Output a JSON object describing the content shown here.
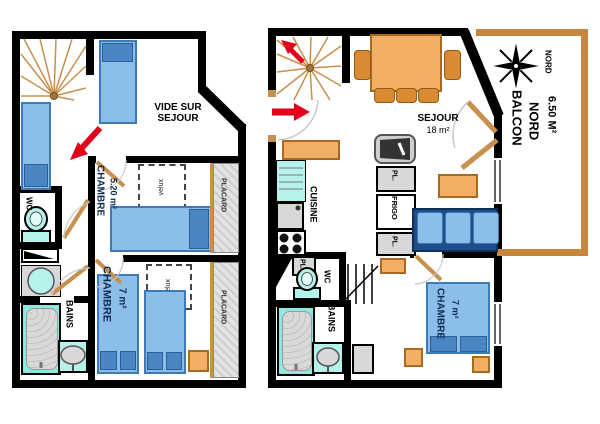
{
  "title": "Apartment floor plan - two levels",
  "left_plan": {
    "vide_sur_sejour": "VIDE SUR SEJOUR",
    "chambre1_name": "CHAMBRE",
    "chambre1_area": "5.20 m²",
    "velux1": "velux",
    "placard_top": "PLACARD",
    "chambre2_name": "CHAMBRE",
    "chambre2_area": "7 m²",
    "velux2": "velux",
    "placard_bottom": "PLACARD",
    "bains": "BAINS",
    "wc": "WC"
  },
  "right_plan": {
    "sejour_name": "SEJOUR",
    "sejour_area": "18 m²",
    "cuisine": "CUISINE",
    "pl_1": "PL.",
    "frigo": "FRIGO",
    "pl_2": "PL.",
    "pl_3": "PL.",
    "wc": "WC",
    "bains": "BAINS",
    "chambre_name": "CHAMBRE",
    "chambre_area": "7 m²",
    "balcon_line1": "BALCON",
    "balcon_line2": "NORD",
    "balcon_area": "6.50 M²",
    "nord_small": "NORD"
  },
  "colors": {
    "wall": "#000000",
    "bed_fill": "#8BBEE8",
    "pillow": "#4A86C4",
    "sofa": "#1D4E89",
    "furniture_orange": "#F2AE64",
    "wood": "#C8904C",
    "fixture_cyan": "#B5F2EC",
    "placard_gray": "#D8D8D8",
    "arrow_red": "#E2001A",
    "balcony_border": "#C8863C"
  }
}
